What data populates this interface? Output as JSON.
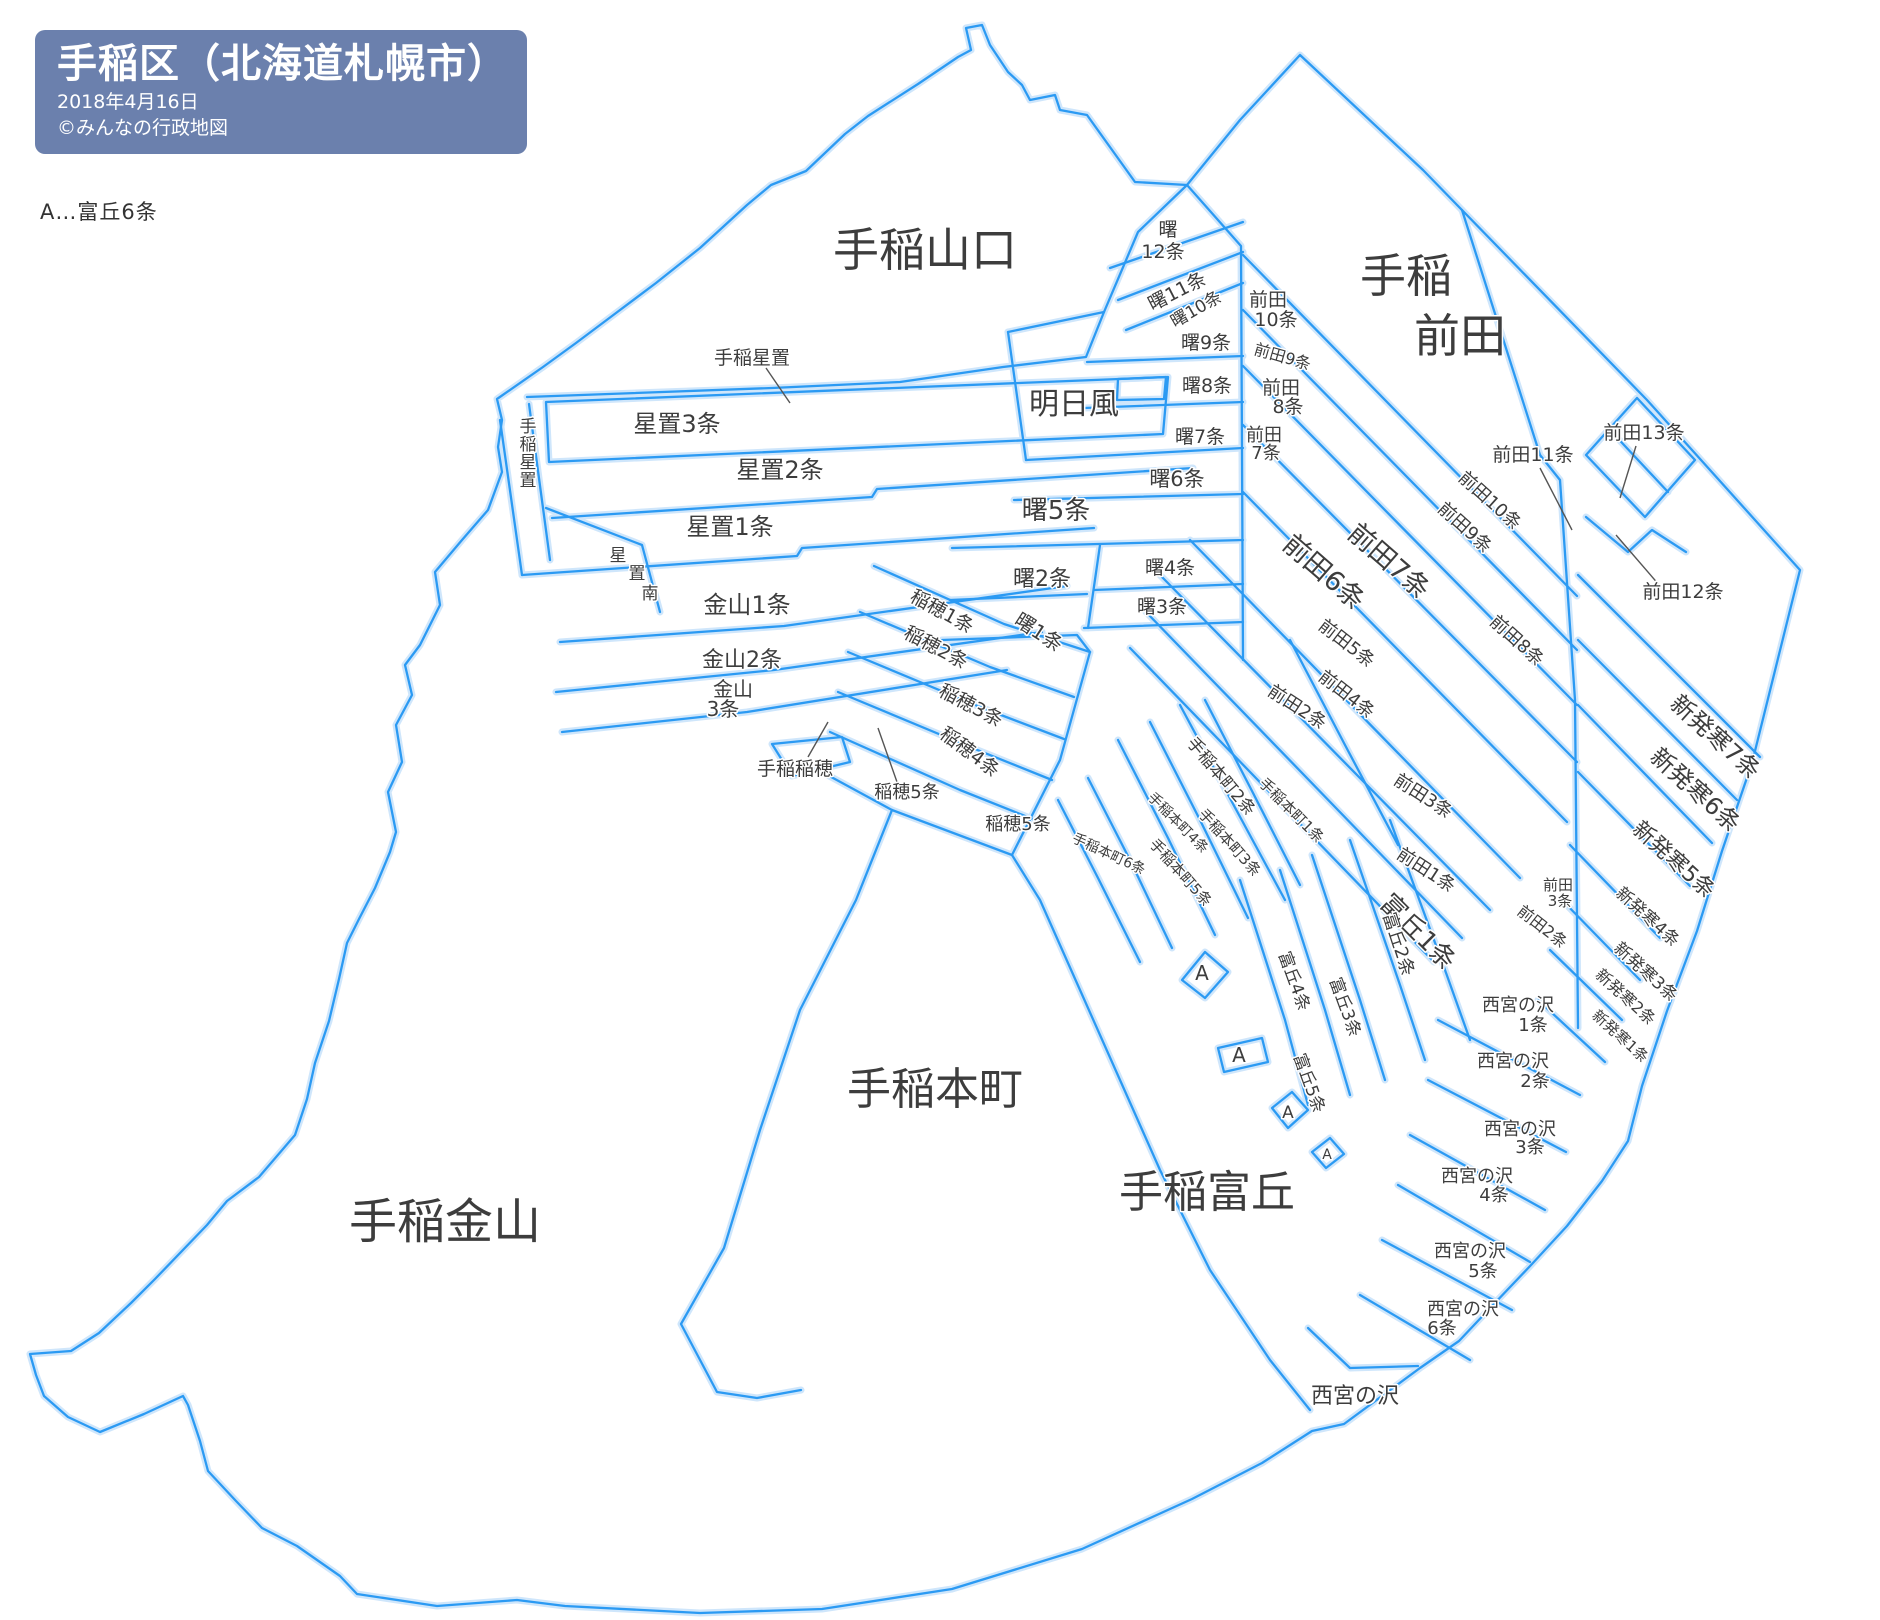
{
  "header": {
    "title": "手稲区（北海道札幌市）",
    "date": "2018年4月16日",
    "copyright": "©みんなの行政地図"
  },
  "legend": {
    "note": "A…富丘6条"
  },
  "colors": {
    "boundary_line": "#2b9af3",
    "boundary_halo": "#cfe6fb",
    "label_text": "#3d3d3d",
    "header_bg": "#6b80ad",
    "header_text": "#ffffff"
  },
  "map": {
    "labels": [
      {
        "n": "teine-yamaguchi",
        "t": "手稲山口",
        "x": 925,
        "y": 266,
        "s": 46
      },
      {
        "n": "teine-maeda",
        "s": 46,
        "lines": [
          [
            "手稲",
            1406,
            292
          ],
          [
            "前田",
            1460,
            352
          ]
        ]
      },
      {
        "n": "asukaze",
        "t": "明日風",
        "x": 1074,
        "y": 414,
        "s": 30
      },
      {
        "n": "teine-kanayama",
        "t": "手稲金山",
        "x": 445,
        "y": 1238,
        "s": 48
      },
      {
        "n": "teine-honcho",
        "t": "手稲本町",
        "x": 935,
        "y": 1104,
        "s": 44
      },
      {
        "n": "teine-tomioka",
        "t": "手稲富丘",
        "x": 1207,
        "y": 1207,
        "s": 44
      },
      {
        "n": "nishinomiyanosawa",
        "t": "西宮の沢",
        "x": 1355,
        "y": 1403,
        "s": 22
      },
      {
        "n": "hoshioki-3",
        "t": "星置3条",
        "x": 677,
        "y": 432,
        "s": 24
      },
      {
        "n": "hoshioki-2",
        "t": "星置2条",
        "x": 780,
        "y": 478,
        "s": 24
      },
      {
        "n": "hoshioki-1",
        "t": "星置1条",
        "x": 730,
        "y": 535,
        "s": 24
      },
      {
        "n": "teine-hoshioki-callout",
        "t": "手稲星置",
        "x": 752,
        "y": 364,
        "s": 19
      },
      {
        "n": "teine-hoshioki-vertical",
        "s": 17,
        "lines": [
          [
            "手",
            528,
            432
          ],
          [
            "稲",
            528,
            450
          ],
          [
            "星",
            528,
            468
          ],
          [
            "置",
            528,
            486
          ]
        ]
      },
      {
        "n": "hoshioki-minami",
        "s": 17,
        "lines": [
          [
            "星",
            618,
            561
          ],
          [
            "置",
            637,
            579
          ],
          [
            "南",
            650,
            599
          ]
        ]
      },
      {
        "n": "kanayama-1",
        "t": "金山1条",
        "x": 747,
        "y": 613,
        "s": 24
      },
      {
        "n": "kanayama-2",
        "t": "金山2条",
        "x": 742,
        "y": 667,
        "s": 22
      },
      {
        "n": "kanayama-3",
        "s": 20,
        "lines": [
          [
            "金山",
            733,
            696
          ],
          [
            "3条",
            723,
            716
          ]
        ]
      },
      {
        "n": "inaho-1",
        "t": "稲穂1条",
        "x": 939,
        "y": 617,
        "s": 19,
        "r": 29
      },
      {
        "n": "inaho-2",
        "t": "稲穂2条",
        "x": 933,
        "y": 653,
        "s": 19,
        "r": 28
      },
      {
        "n": "inaho-3",
        "t": "稲穂3条",
        "x": 968,
        "y": 711,
        "s": 19,
        "r": 28
      },
      {
        "n": "inaho-4",
        "t": "稲穂4条",
        "x": 966,
        "y": 757,
        "s": 19,
        "r": 37
      },
      {
        "n": "inaho-5-callout",
        "t": "稲穂5条",
        "x": 907,
        "y": 798,
        "s": 18
      },
      {
        "n": "inaho-5",
        "t": "稲穂5条",
        "x": 1018,
        "y": 830,
        "s": 18
      },
      {
        "n": "teine-inaho-callout",
        "t": "手稲稲穂",
        "x": 795,
        "y": 775,
        "s": 19
      },
      {
        "n": "akebono-12",
        "s": 19,
        "lines": [
          [
            "曙",
            1168,
            236
          ],
          [
            "12条",
            1163,
            258
          ]
        ]
      },
      {
        "n": "akebono-11",
        "t": "曙11条",
        "x": 1180,
        "y": 297,
        "s": 19,
        "r": -27
      },
      {
        "n": "akebono-10",
        "t": "曙10条",
        "x": 1199,
        "y": 314,
        "s": 17,
        "r": -30
      },
      {
        "n": "akebono-9",
        "t": "曙9条",
        "x": 1206,
        "y": 349,
        "s": 19
      },
      {
        "n": "akebono-8",
        "t": "曙8条",
        "x": 1207,
        "y": 392,
        "s": 19
      },
      {
        "n": "akebono-7",
        "t": "曙7条",
        "x": 1200,
        "y": 443,
        "s": 19
      },
      {
        "n": "akebono-6",
        "t": "曙6条",
        "x": 1177,
        "y": 486,
        "s": 21
      },
      {
        "n": "akebono-5",
        "t": "曙5条",
        "x": 1056,
        "y": 519,
        "s": 26
      },
      {
        "n": "akebono-4",
        "t": "曙4条",
        "x": 1170,
        "y": 574,
        "s": 19
      },
      {
        "n": "akebono-3",
        "t": "曙3条",
        "x": 1162,
        "y": 613,
        "s": 19
      },
      {
        "n": "akebono-2",
        "t": "曙2条",
        "x": 1042,
        "y": 586,
        "s": 22
      },
      {
        "n": "akebono-1",
        "t": "曙1条",
        "x": 1035,
        "y": 638,
        "s": 20,
        "r": 33
      },
      {
        "n": "maeda-10-top",
        "s": 19,
        "lines": [
          [
            "前田",
            1268,
            306
          ],
          [
            "10条",
            1276,
            326
          ]
        ]
      },
      {
        "n": "maeda-9-top",
        "t": "前田9条",
        "x": 1281,
        "y": 362,
        "s": 16,
        "r": 16
      },
      {
        "n": "maeda-8-top",
        "s": 19,
        "lines": [
          [
            "前田",
            1281,
            394
          ],
          [
            "8条",
            1288,
            413
          ]
        ]
      },
      {
        "n": "maeda-7-small",
        "s": 18,
        "lines": [
          [
            "前田",
            1264,
            441
          ],
          [
            "7条",
            1266,
            459
          ]
        ]
      },
      {
        "n": "maeda-10",
        "t": "前田10条",
        "x": 1486,
        "y": 505,
        "s": 18,
        "r": 42
      },
      {
        "n": "maeda-9",
        "t": "前田9条",
        "x": 1461,
        "y": 532,
        "s": 18,
        "r": 42
      },
      {
        "n": "maeda-8",
        "t": "前田8条",
        "x": 1513,
        "y": 645,
        "s": 18,
        "r": 42
      },
      {
        "n": "maeda-7",
        "t": "前田7条",
        "x": 1383,
        "y": 568,
        "s": 27,
        "r": 41
      },
      {
        "n": "maeda-6",
        "t": "前田6条",
        "x": 1318,
        "y": 579,
        "s": 27,
        "r": 41
      },
      {
        "n": "maeda-5",
        "t": "前田5条",
        "x": 1343,
        "y": 648,
        "s": 18,
        "r": 38
      },
      {
        "n": "maeda-4",
        "t": "前田4条",
        "x": 1343,
        "y": 699,
        "s": 18,
        "r": 38
      },
      {
        "n": "maeda-3",
        "t": "前田3条",
        "x": 1420,
        "y": 801,
        "s": 18,
        "r": 33
      },
      {
        "n": "maeda-2",
        "t": "前田2条",
        "x": 1294,
        "y": 712,
        "s": 18,
        "r": 33
      },
      {
        "n": "maeda-1",
        "t": "前田1条",
        "x": 1423,
        "y": 875,
        "s": 18,
        "r": 33
      },
      {
        "n": "maeda-2-east",
        "t": "前田2条",
        "x": 1539,
        "y": 931,
        "s": 16,
        "r": 38
      },
      {
        "n": "maeda-3-east",
        "s": 15,
        "lines": [
          [
            "前田",
            1558,
            890
          ],
          [
            "3条",
            1560,
            906
          ]
        ]
      },
      {
        "n": "maeda-11-callout",
        "t": "前田11条",
        "x": 1533,
        "y": 461,
        "s": 19
      },
      {
        "n": "maeda-12-callout",
        "t": "前田12条",
        "x": 1683,
        "y": 598,
        "s": 19
      },
      {
        "n": "maeda-13-callout",
        "t": "前田13条",
        "x": 1644,
        "y": 439,
        "s": 19
      },
      {
        "n": "shinhassamu-7",
        "t": "新発寒7条",
        "x": 1710,
        "y": 743,
        "s": 24,
        "r": 42
      },
      {
        "n": "shinhassamu-6",
        "t": "新発寒6条",
        "x": 1690,
        "y": 796,
        "s": 24,
        "r": 42
      },
      {
        "n": "shinhassamu-5",
        "t": "新発寒5条",
        "x": 1669,
        "y": 865,
        "s": 22,
        "r": 42
      },
      {
        "n": "shinhassamu-4",
        "t": "新発寒4条",
        "x": 1644,
        "y": 921,
        "s": 17,
        "r": 42
      },
      {
        "n": "shinhassamu-3",
        "t": "新発寒3条",
        "x": 1642,
        "y": 976,
        "s": 17,
        "r": 42
      },
      {
        "n": "shinhassamu-2",
        "t": "新発寒2条",
        "x": 1622,
        "y": 1001,
        "s": 16,
        "r": 42
      },
      {
        "n": "shinhassamu-1",
        "t": "新発寒1条",
        "x": 1617,
        "y": 1040,
        "s": 15,
        "r": 42
      },
      {
        "n": "honcho-2",
        "t": "手稲本町2条",
        "x": 1217,
        "y": 780,
        "s": 17,
        "r": 50
      },
      {
        "n": "honcho-1",
        "t": "手稲本町1条",
        "x": 1288,
        "y": 814,
        "s": 15,
        "r": 45
      },
      {
        "n": "honcho-4",
        "t": "手稲本町4条",
        "x": 1175,
        "y": 826,
        "s": 14,
        "r": 45
      },
      {
        "n": "honcho-3",
        "t": "手稲本町3条",
        "x": 1226,
        "y": 846,
        "s": 15,
        "r": 48
      },
      {
        "n": "honcho-5",
        "t": "手稲本町5条",
        "x": 1177,
        "y": 876,
        "s": 15,
        "r": 48
      },
      {
        "n": "honcho-6",
        "t": "手稲本町6条",
        "x": 1107,
        "y": 858,
        "s": 14,
        "r": 25
      },
      {
        "n": "tomioka-1",
        "t": "富丘1条",
        "x": 1412,
        "y": 938,
        "s": 26,
        "r": 45
      },
      {
        "n": "tomioka-2",
        "t": "富丘2条",
        "x": 1393,
        "y": 946,
        "s": 18,
        "r": 72
      },
      {
        "n": "tomioka-3",
        "t": "富丘3条",
        "x": 1340,
        "y": 1009,
        "s": 17,
        "r": 70
      },
      {
        "n": "tomioka-4",
        "t": "富丘4条",
        "x": 1289,
        "y": 983,
        "s": 17,
        "r": 70
      },
      {
        "n": "tomioka-5",
        "t": "富丘5条",
        "x": 1304,
        "y": 1085,
        "s": 17,
        "r": 70
      },
      {
        "n": "tomioka-a-1",
        "t": "A",
        "x": 1202,
        "y": 980,
        "s": 20
      },
      {
        "n": "tomioka-a-2",
        "t": "A",
        "x": 1239,
        "y": 1062,
        "s": 20
      },
      {
        "n": "tomioka-a-3",
        "t": "A",
        "x": 1288,
        "y": 1118,
        "s": 17
      },
      {
        "n": "tomioka-a-4",
        "t": "A",
        "x": 1327,
        "y": 1159,
        "s": 14
      },
      {
        "n": "nishinomiyanosawa-1",
        "s": 18,
        "lines": [
          [
            "西宮の沢",
            1518,
            1011
          ],
          [
            "1条",
            1533,
            1031
          ]
        ]
      },
      {
        "n": "nishinomiyanosawa-2",
        "s": 18,
        "lines": [
          [
            "西宮の沢",
            1513,
            1067
          ],
          [
            "2条",
            1535,
            1087
          ]
        ]
      },
      {
        "n": "nishinomiyanosawa-3",
        "s": 18,
        "lines": [
          [
            "西宮の沢",
            1520,
            1135
          ],
          [
            "3条",
            1530,
            1153
          ]
        ]
      },
      {
        "n": "nishinomiyanosawa-4",
        "s": 18,
        "lines": [
          [
            "西宮の沢",
            1477,
            1182
          ],
          [
            "4条",
            1494,
            1201
          ]
        ]
      },
      {
        "n": "nishinomiyanosawa-5",
        "s": 18,
        "lines": [
          [
            "西宮の沢",
            1470,
            1257
          ],
          [
            "5条",
            1483,
            1277
          ]
        ]
      },
      {
        "n": "nishinomiyanosawa-6",
        "s": 18,
        "lines": [
          [
            "西宮の沢",
            1463,
            1315
          ],
          [
            "6条",
            1442,
            1334
          ]
        ]
      }
    ]
  }
}
